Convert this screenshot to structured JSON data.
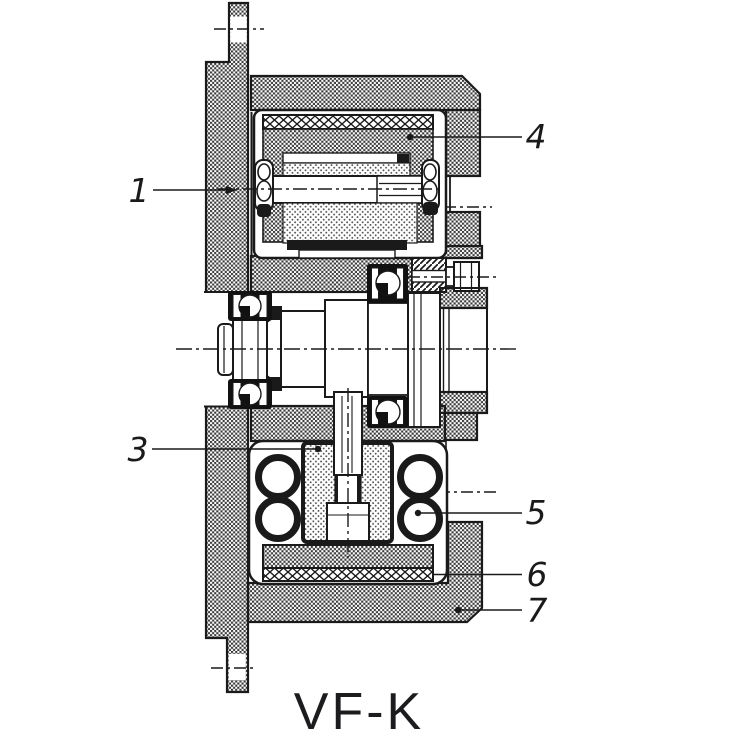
{
  "figure": {
    "caption": "VF-K",
    "callouts": [
      {
        "label": "1"
      },
      {
        "label": "3"
      },
      {
        "label": "4"
      },
      {
        "label": "5"
      },
      {
        "label": "6"
      },
      {
        "label": "7"
      }
    ]
  },
  "colors": {
    "ink": "#1a1a1a",
    "paper": "#ffffff"
  }
}
